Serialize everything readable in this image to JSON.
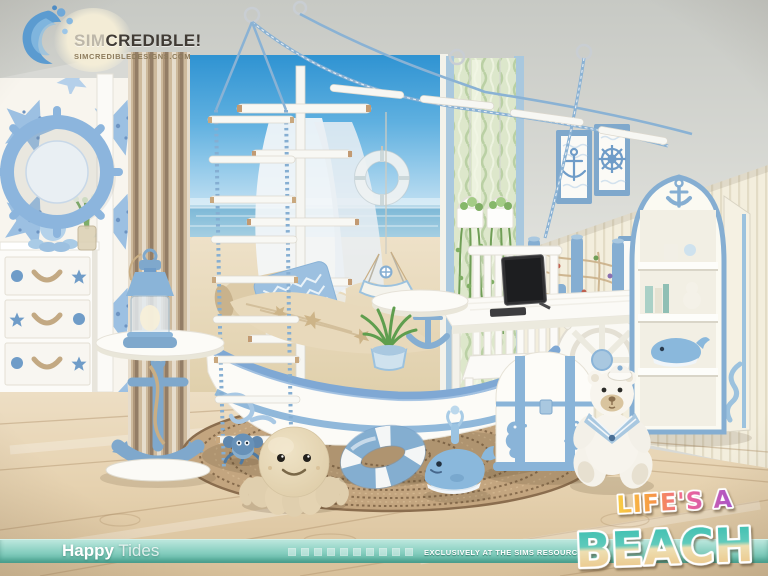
{
  "logo": {
    "brand_sim": "SIM",
    "brand_credible": "CREDIBLE!",
    "website": "SIMCREDIBLEDESIGNS.COM"
  },
  "footer": {
    "collection_bold": "Happy",
    "collection_light": "Tides",
    "tagline": "EXCLUSIVELY AT THE SIMS RESOURCE",
    "decor_square_count": 10
  },
  "badge": {
    "line1": "LIFE'S A",
    "line2": "BEACH"
  },
  "palette": {
    "accent_blue": "#7fa8cc",
    "pale_blue": "#9cc0e0",
    "teal_bar": "#5cb8a6",
    "mint_square": "#bfeadf",
    "wood_floor": "#e3cfae",
    "sky_mural": "#3f9fd9",
    "sand": "#e8dabc",
    "wall_cream": "#f3eedd",
    "curtain_tan": "#c9b69b",
    "curtain_green": "#dde8cb",
    "life_gradient": [
      "#f8cf45",
      "#f79a43",
      "#ef6498",
      "#a855c8"
    ],
    "beach_gradient": [
      "#35bdaf",
      "#e9bd79"
    ]
  },
  "scene": {
    "room_theme": "nautical kids bedroom render",
    "items": [
      "wave-splash-logo",
      "starfish-wallpaper",
      "ship-wheel-mirror",
      "octopus-figurine",
      "plant-vase",
      "drawer-dresser",
      "striped-curtain",
      "beach-mural",
      "ship-mast-and-sails",
      "rope-ladder",
      "rope-canopy",
      "life-preserver-wall-ring",
      "sheer-green-curtain",
      "hanging-planters",
      "anchor-wall-frame",
      "ship-wheel-wall-frame",
      "rope-net-rail",
      "white-desk",
      "ship-wheel-desk-side",
      "tablet-on-stand",
      "adirondack-chair",
      "arched-bookshelf",
      "whale-figurine",
      "boat-shaped-daybed",
      "chevron-pillow",
      "starfish-bedding",
      "sailboat-mobile",
      "potted-plant",
      "round-woven-rug",
      "anchor-side-table",
      "lighthouse-lantern-lamp",
      "treasure-chest",
      "sailor-teddy-bear",
      "octopus-plush",
      "crab-toy",
      "life-ring-toy",
      "whale-toy",
      "whitewashed-wood-floor"
    ]
  }
}
